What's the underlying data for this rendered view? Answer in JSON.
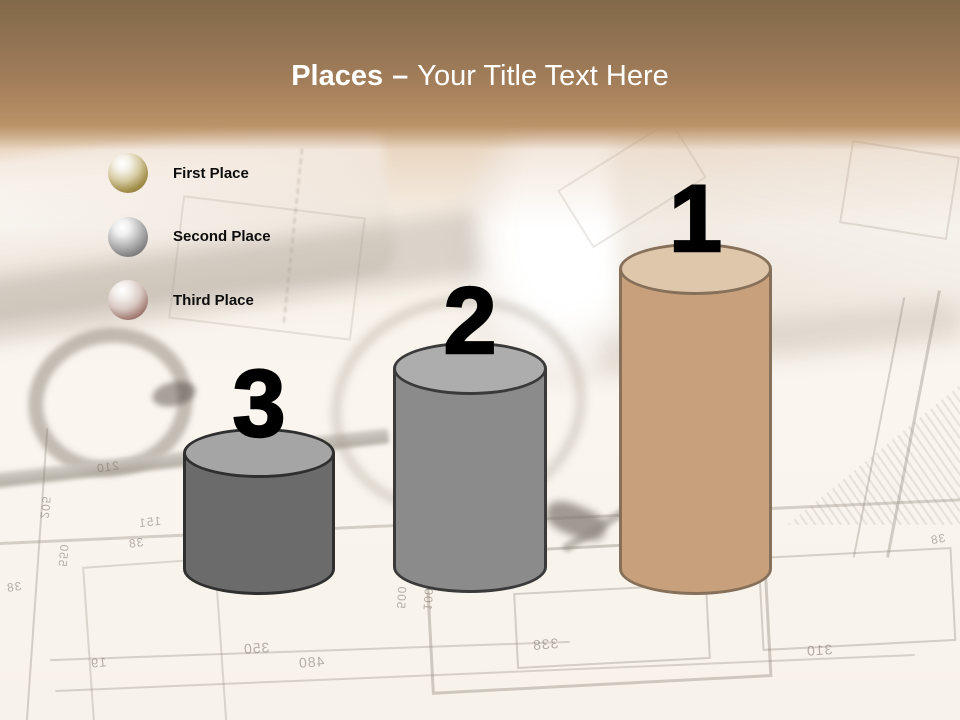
{
  "title": {
    "bold": "Places",
    "separator": "–",
    "rest": "Your Title Text Here"
  },
  "legend": {
    "items": [
      {
        "label": "First Place",
        "icon": "gold-sphere-icon",
        "color": "#a4914e"
      },
      {
        "label": "Second Place",
        "icon": "silver-sphere-icon",
        "color": "#8a8a8a"
      },
      {
        "label": "Third Place",
        "icon": "bronze-sphere-icon",
        "color": "#7c4f47"
      }
    ]
  },
  "cylinders": [
    {
      "rank": "1",
      "category": "First Place",
      "top_color": "#dec7ab",
      "body_color": "#c9a07c",
      "outline_color": "#87705a"
    },
    {
      "rank": "2",
      "category": "Second Place",
      "top_color": "#adadad",
      "body_color": "#8b8b8b",
      "outline_color": "#3a3a3a"
    },
    {
      "rank": "3",
      "category": "Third Place",
      "top_color": "#a5a5a5",
      "body_color": "#6b6b6b",
      "outline_color": "#2f2f2f"
    }
  ],
  "chart_data": {
    "type": "bar",
    "subtype": "3d-cylinder-podium",
    "title": "Places – Your Title Text Here",
    "categories": [
      "First Place",
      "Second Place",
      "Third Place"
    ],
    "series": [
      {
        "name": "Place ranking",
        "values": [
          1,
          2,
          3
        ]
      }
    ],
    "bar_labels": [
      "1",
      "2",
      "3"
    ],
    "relative_heights": [
      1.0,
      0.71,
      0.47
    ],
    "legend_position": "left",
    "axes_visible": false,
    "gridlines": false
  },
  "theme": {
    "header_brown_top": "#826949",
    "header_brown_bottom": "#bb9368",
    "background_cream": "#f8f2e9",
    "title_color": "#ffffff",
    "label_color": "#0d0d0d"
  },
  "background": {
    "annotations": [
      {
        "text": "350"
      },
      {
        "text": "480"
      },
      {
        "text": "19"
      },
      {
        "text": "38"
      },
      {
        "text": "550"
      },
      {
        "text": "205"
      },
      {
        "text": "151"
      },
      {
        "text": "38"
      },
      {
        "text": "210"
      },
      {
        "text": "500"
      },
      {
        "text": "1000"
      },
      {
        "text": "338"
      },
      {
        "text": "310"
      },
      {
        "text": "38"
      }
    ]
  }
}
